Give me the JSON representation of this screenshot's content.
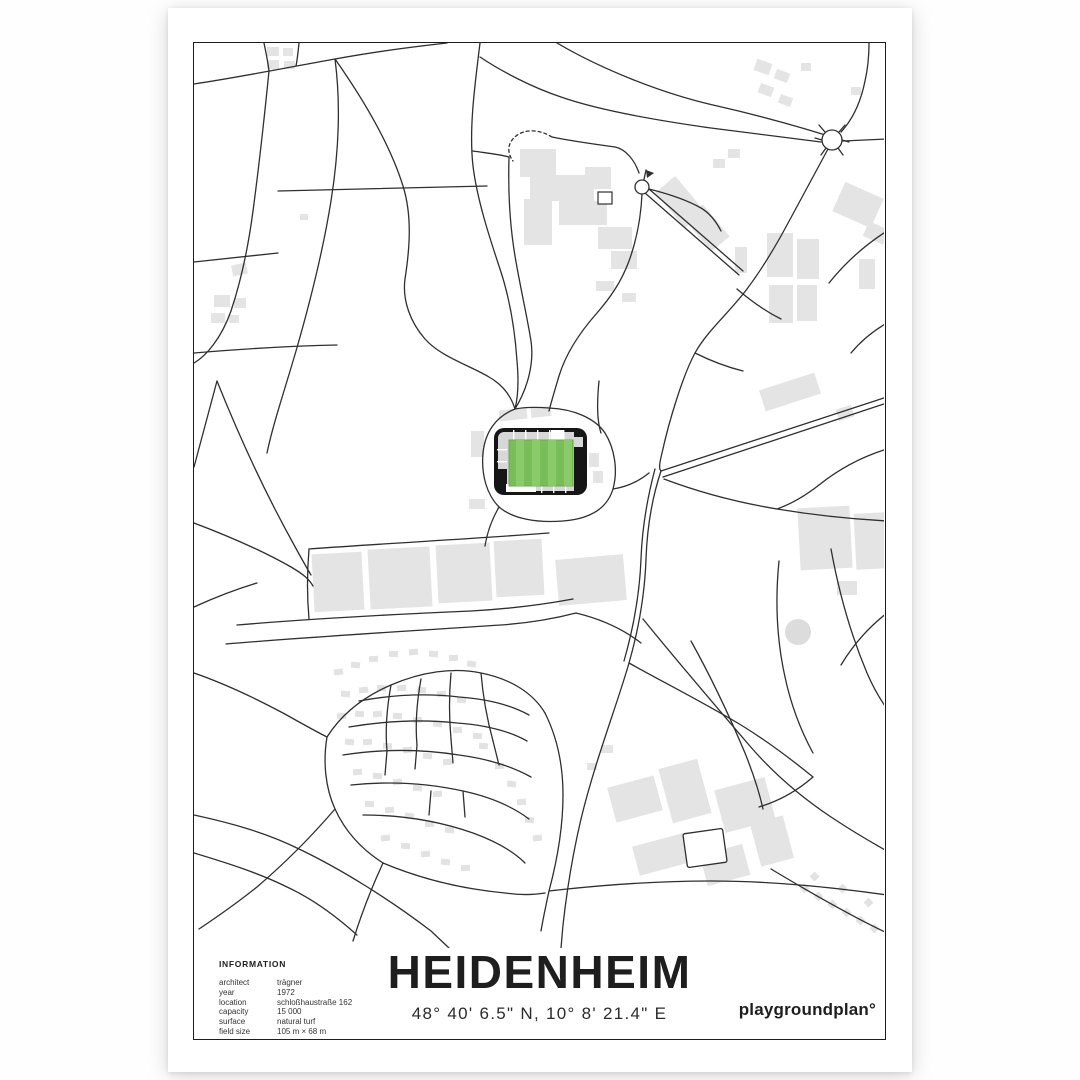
{
  "poster": {
    "title": "HEIDENHEIM",
    "coordinates": "48° 40' 6.5\" N, 10° 8' 21.4\" E",
    "brand": "playgroundplan°",
    "info": {
      "heading": "INFORMATION",
      "rows": [
        {
          "label": "architect",
          "value": "trägner"
        },
        {
          "label": "year",
          "value": "1972"
        },
        {
          "label": "location",
          "value": "schloßhaustraße 162"
        },
        {
          "label": "capacity",
          "value": "15 000"
        },
        {
          "label": "surface",
          "value": "natural turf"
        },
        {
          "label": "field size",
          "value": "105 m × 68 m"
        }
      ]
    },
    "colors": {
      "pitch_green": "#79bd58",
      "pitch_stripe": "#8acb69",
      "stadium_black": "#161616",
      "stand_gray": "#d7d7d7",
      "building_gray": "#e4e4e4",
      "road": "#2f2f2f",
      "frame": "#1d1d1d",
      "paper": "#ffffff"
    }
  }
}
